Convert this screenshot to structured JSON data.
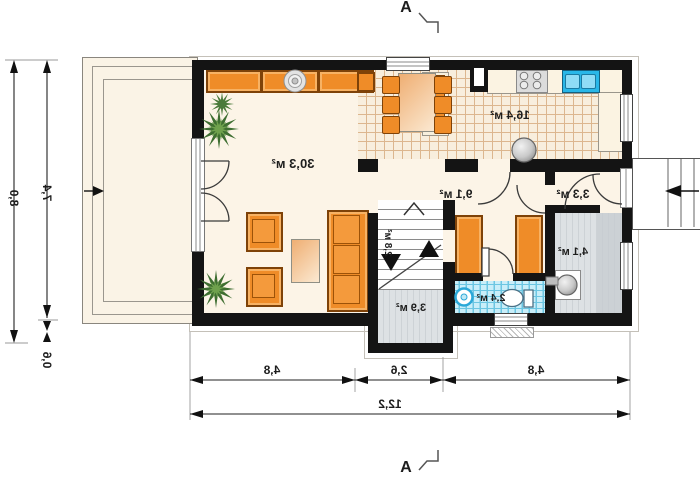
{
  "plan_title": "floor-plan",
  "section": {
    "marker_top": "A",
    "marker_bottom": "A"
  },
  "rooms": {
    "living": {
      "label": "30,3 м²"
    },
    "kitchen": {
      "label": "16,4 м²"
    },
    "hall": {
      "label": "9,1 м²"
    },
    "vestibule": {
      "label": "3,3 м²"
    },
    "utility": {
      "label": "4,1 м²"
    },
    "bathroom": {
      "label": "2,4 м²"
    },
    "entry": {
      "label": "3,9 м²"
    },
    "stairs": {
      "label": "2,8 м²"
    }
  },
  "dimensions": {
    "left": {
      "total": "8,0",
      "main": "7,4",
      "small": "0,6"
    },
    "bottom": {
      "seg1": "4,8",
      "seg2": "2,6",
      "seg3": "4,8",
      "total": "12,2"
    }
  },
  "colors": {
    "wall": "#141414",
    "floor_cream": "#fcf4e7",
    "terrace_cream": "#faf3e6",
    "tile_line": "#dcb68e",
    "furniture_orange": "#ef8c28",
    "bath_tile": "#c9eef9",
    "sink_blue": "#29b7e8",
    "gray_floor": "#dde1e4"
  }
}
